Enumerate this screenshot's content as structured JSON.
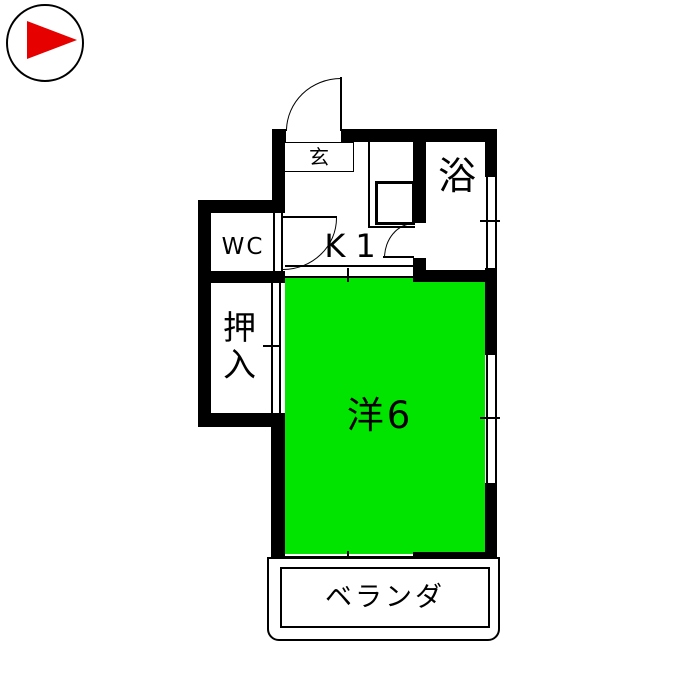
{
  "title": "apartment-floor-plan",
  "colors": {
    "room_fill": "#00e400",
    "compass_red": "#e60000",
    "wall": "#000000",
    "background": "#ffffff"
  },
  "compass": {
    "icon": "right-pointing-triangle-in-circle"
  },
  "rooms": {
    "genkan": {
      "label": "玄"
    },
    "bath": {
      "label": "浴"
    },
    "wc": {
      "label": "WC"
    },
    "kitchen": {
      "label": "K1"
    },
    "closet": {
      "label": "押入"
    },
    "main": {
      "label": "洋6"
    },
    "veranda": {
      "label": "ベランダ"
    }
  }
}
